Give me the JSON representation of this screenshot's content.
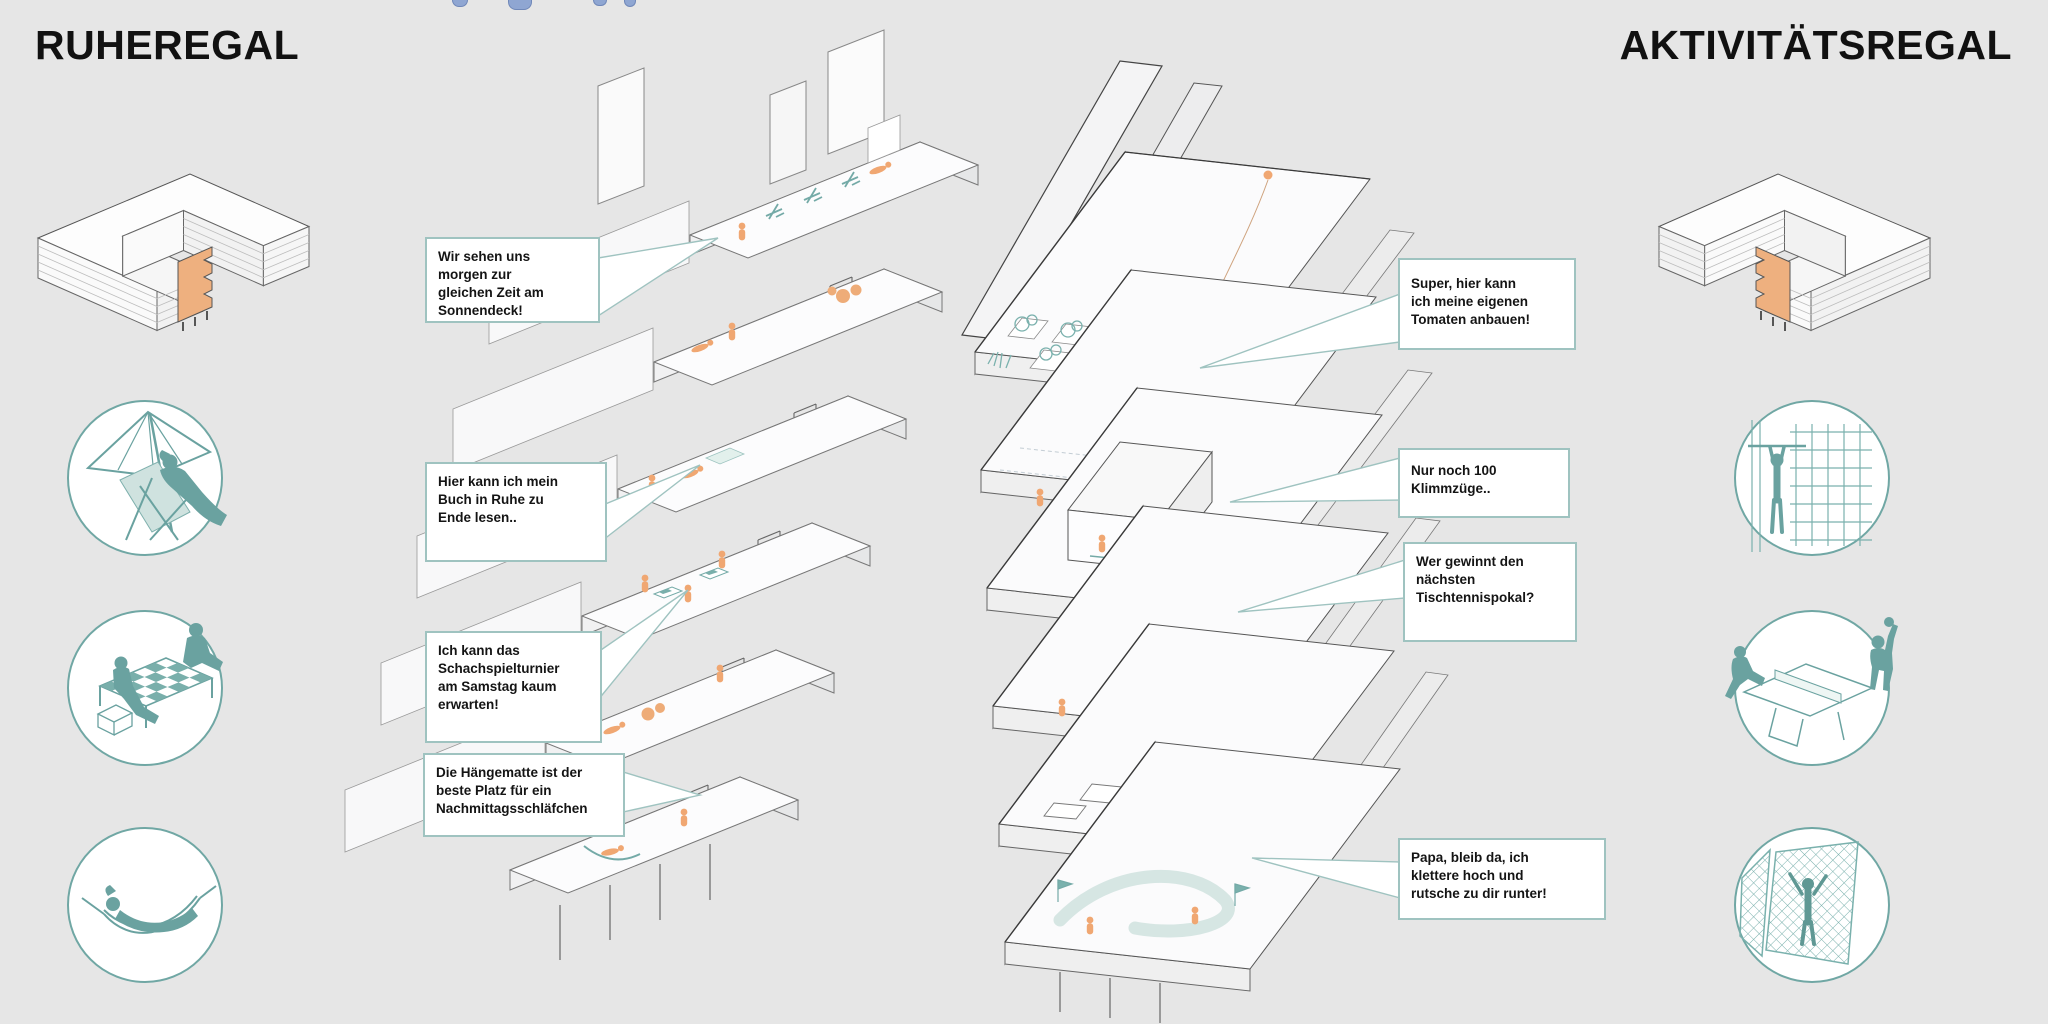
{
  "canvas": {
    "width": 2048,
    "height": 1024,
    "background": "#e6e6e6"
  },
  "titles": {
    "left": "RUHEREGAL",
    "right": "AKTIVITÄTSREGAL"
  },
  "palette": {
    "teal": "#6aa2a0",
    "teal_light": "#9fc3c0",
    "teal_fill": "#79afab",
    "orange_figure": "#f0a772",
    "orange_keyplan": "#eeb07f",
    "callout_border": "#9fc3c0",
    "callout_bg": "#ffffff",
    "text": "#141414",
    "line_gray": "#777777",
    "dark_edge": "#3a3a3a"
  },
  "left_section": {
    "keyplan_name": "ruheregal-location-keyplan",
    "icon_names": [
      "parasol-deckchair-icon",
      "chess-tables-icon",
      "hammock-icon"
    ]
  },
  "right_section": {
    "keyplan_name": "aktivitaetsregal-location-keyplan",
    "icon_names": [
      "pullup-climbing-wall-icon",
      "table-tennis-icon",
      "climbing-nets-icon"
    ]
  },
  "callouts_left": [
    {
      "text": "Wir sehen uns\nmorgen zur\ngleichen Zeit am\nSonnendeck!"
    },
    {
      "text": "Hier kann ich mein\nBuch in Ruhe zu\nEnde lesen.."
    },
    {
      "text": "Ich kann das\nSchachspielturnier\nam Samstag kaum\nerwarten!"
    },
    {
      "text": "Die Hängematte ist der\nbeste Platz für ein\nNachmittagsschläfchen"
    }
  ],
  "callouts_right": [
    {
      "text": "Super, hier kann\nich meine eigenen\nTomaten anbauen!"
    },
    {
      "text": "Nur noch 100\nKlimmzüge.."
    },
    {
      "text": "Wer gewinnt den\nnächsten\nTischtennispokal?"
    },
    {
      "text": "Papa, bleib da, ich\nklettere hoch und\nrutsche zu dir runter!"
    }
  ]
}
